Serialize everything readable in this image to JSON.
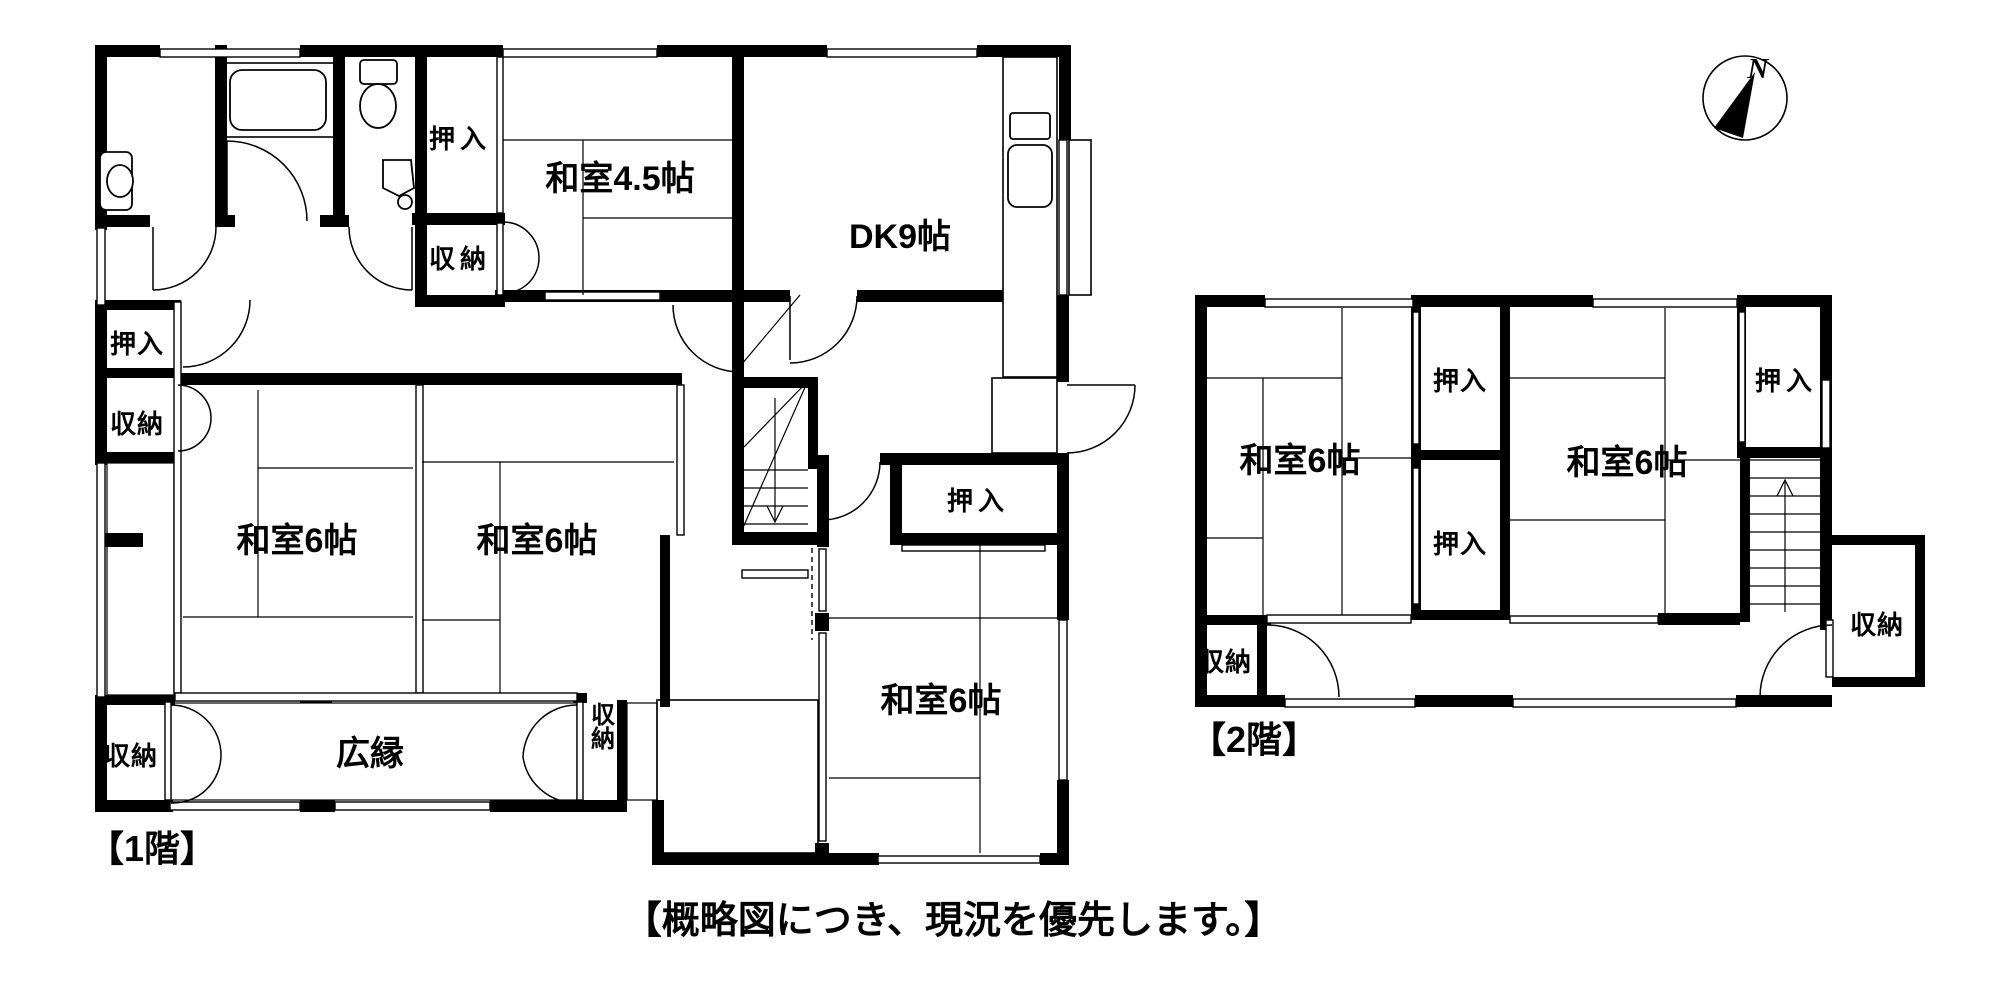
{
  "compass": {
    "label": "N"
  },
  "caption": "【概略図につき、現況を優先します。】",
  "floor1": {
    "title": "【1階】",
    "labels": {
      "oshiire_north": "押入",
      "shunou_north": "収納",
      "washitsu_45": "和室4.5帖",
      "dk": "DK9帖",
      "oshiire_west": "押入",
      "shunou_west": "収納",
      "washitsu_west": "和室6帖",
      "washitsu_center": "和室6帖",
      "hiroen": "広縁",
      "shunou_southwest": "収納",
      "shunou_south": "収納",
      "oshiire_east": "押入",
      "washitsu_southeast": "和室6帖"
    }
  },
  "floor2": {
    "title": "【2階】",
    "labels": {
      "washitsu_left": "和室6帖",
      "washitsu_right": "和室6帖",
      "oshiire_upper": "押入",
      "oshiire_lower": "押入",
      "oshiire_right": "押入",
      "shunou_right": "収納",
      "shunou_left": "収納"
    }
  }
}
